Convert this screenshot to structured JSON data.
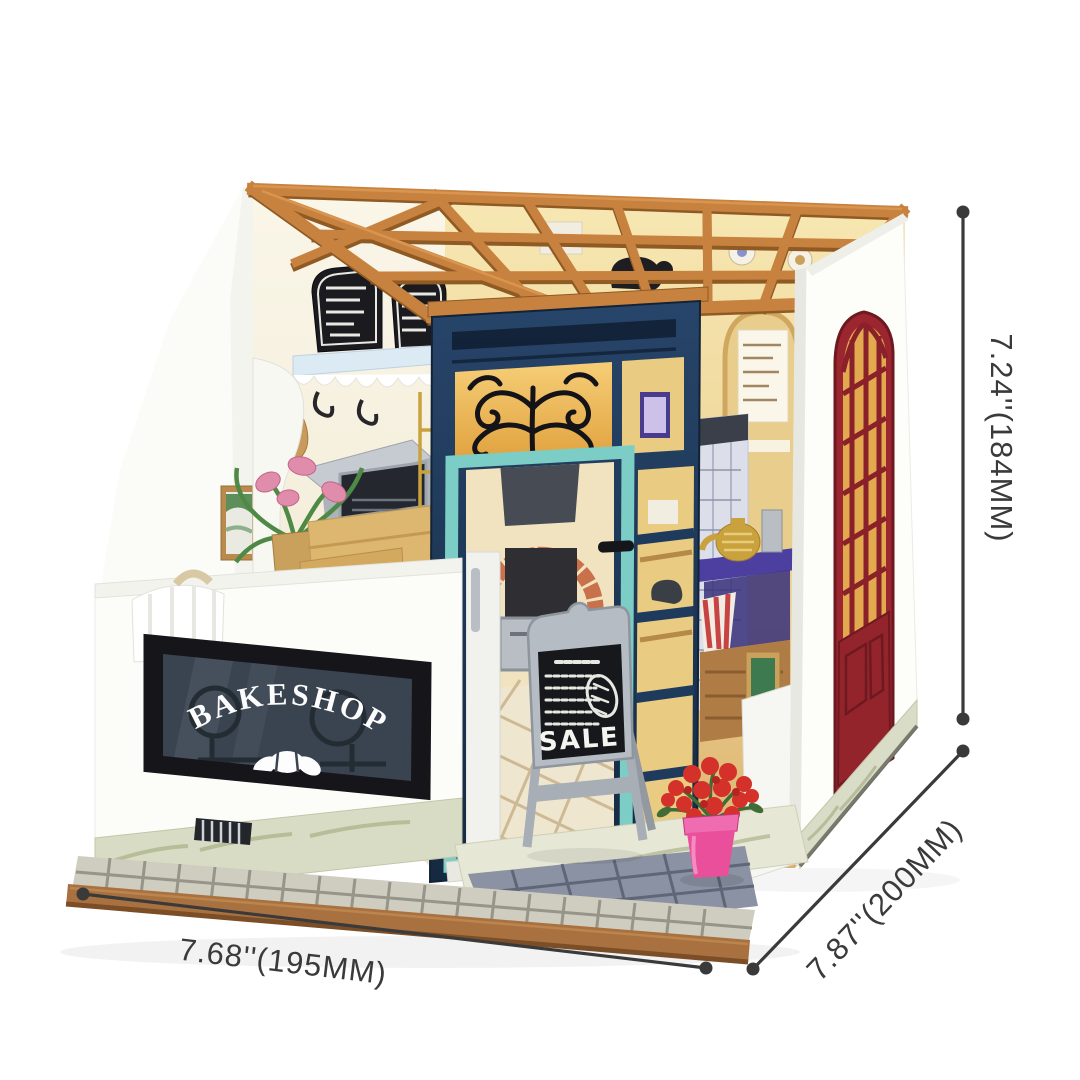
{
  "image_type": "product dimension photo",
  "product": {
    "description": "DIY miniature bakeshop dollhouse kit shown in three-quarter view with size callouts",
    "storefront_sign": "BAKESHOP",
    "sale_board_text": "SALE"
  },
  "dimensions": {
    "height_label": "7.24''(184MM)",
    "width_label": "7.68''(195MM)",
    "depth_label": "7.87''(200MM)"
  },
  "colors": {
    "annotation_line": "#3a3a3a",
    "roof_beams_terracotta": "#c8823f",
    "roof_beam_shadow": "#8f5a24",
    "storefront_navy": "#1e3a5c",
    "door_frame_teal": "#7bcdc5",
    "side_door_red": "#9c2630",
    "interior_wall_yellow": "#eccf8e",
    "sign_black": "#141418",
    "marble_base": "#dcdeca",
    "wood_base": "#a9713f",
    "flower_pot_pink": "#e94f9c",
    "flowers_red": "#d92f26"
  }
}
